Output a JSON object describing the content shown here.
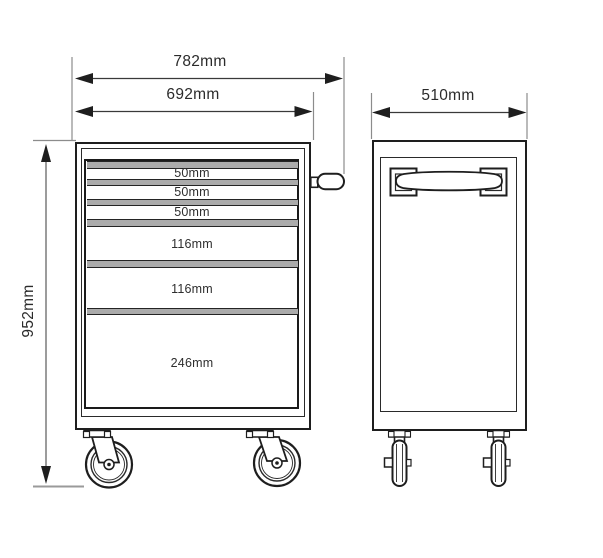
{
  "dimensions": {
    "overall_width": "782mm",
    "cabinet_width": "692mm",
    "depth": "510mm",
    "overall_height": "952mm"
  },
  "drawers": [
    {
      "label": "50mm"
    },
    {
      "label": "50mm"
    },
    {
      "label": "50mm"
    },
    {
      "label": "116mm"
    },
    {
      "label": "116mm"
    },
    {
      "label": "246mm"
    }
  ],
  "colors": {
    "line": "#1e1e1e",
    "extension_line": "#8c8c8c",
    "band_fill": "#ababab",
    "background": "#ffffff"
  }
}
